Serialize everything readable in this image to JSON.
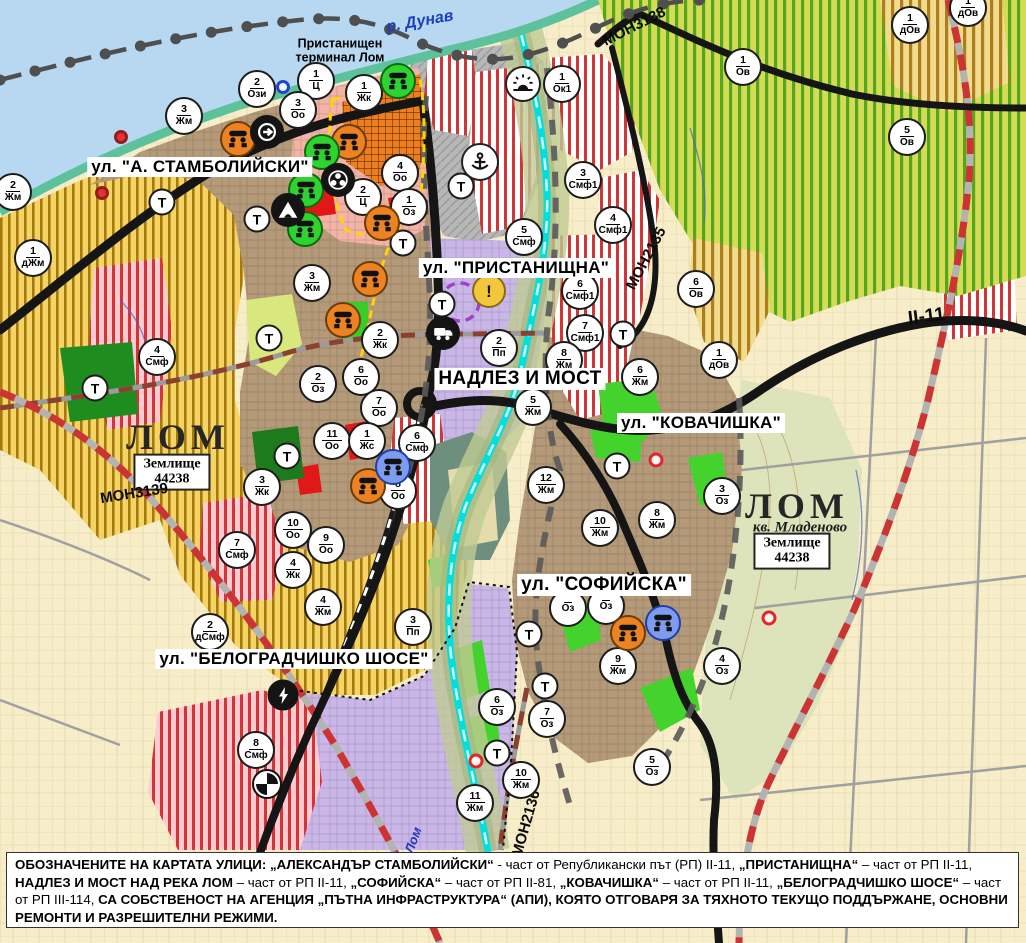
{
  "labels": {
    "danube": "р. Дунав",
    "port_terminal_line1": "Пристанищен",
    "port_terminal_line2": "терминал Лом",
    "lom_river": "Лом",
    "t_symbol": "Т"
  },
  "street_labels": [
    {
      "id": "stamboliyski",
      "text": "ул. \"А. СТАМБОЛИЙСКИ\"",
      "x": 200,
      "y": 167,
      "size": 17
    },
    {
      "id": "pristanishtna",
      "text": "ул. \"ПРИСТАНИЩНА\"",
      "x": 516,
      "y": 268,
      "size": 17
    },
    {
      "id": "nadlez-i-most",
      "text": "НАДЛЕЗ И МОСТ",
      "x": 520,
      "y": 379,
      "size": 19
    },
    {
      "id": "kovachishka",
      "text": "ул. \"КОВАЧИШКА\"",
      "x": 701,
      "y": 423,
      "size": 17
    },
    {
      "id": "sofiyska",
      "text": "ул. \"СОФИЙСКА\"",
      "x": 604,
      "y": 585,
      "size": 19
    },
    {
      "id": "belogradchishko",
      "text": "ул. \"БЕЛОГРАДЧИШКО ШОСЕ\"",
      "x": 294,
      "y": 659,
      "size": 17
    }
  ],
  "city_labels": [
    {
      "id": "lom-west",
      "text": "ЛОМ",
      "x": 178,
      "y": 437
    },
    {
      "id": "lom-east",
      "text": "ЛОМ",
      "x": 797,
      "y": 506
    }
  ],
  "sub_labels": [
    {
      "id": "kv-mladenovo",
      "text": "кв. Младеново",
      "x": 800,
      "y": 528
    }
  ],
  "land_boxes": [
    {
      "line1": "Землище",
      "line2": "44238",
      "x": 172,
      "y": 472
    },
    {
      "line1": "Землище",
      "line2": "44238",
      "x": 792,
      "y": 551
    }
  ],
  "road_labels": [
    {
      "text": "МОН3139",
      "x": 148,
      "y": 494,
      "rotate": -9,
      "size": 15
    },
    {
      "text": "МОН3138",
      "x": 636,
      "y": 29,
      "rotate": -27,
      "size": 15
    },
    {
      "text": "МОН2135",
      "x": 632,
      "y": 260,
      "rotate": -62,
      "size": 15
    },
    {
      "text": "МОН2136",
      "x": 507,
      "y": 827,
      "rotate": -74,
      "size": 15
    },
    {
      "text": "II-11",
      "x": 928,
      "y": 317,
      "rotate": -7,
      "size": 19
    }
  ],
  "zone_markers": [
    {
      "num": "2",
      "code": "Ози",
      "x": 257,
      "y": 89
    },
    {
      "num": "1",
      "code": "Ц",
      "x": 316,
      "y": 81
    },
    {
      "num": "3",
      "code": "Оо",
      "x": 298,
      "y": 110
    },
    {
      "num": "1",
      "code": "Жк",
      "x": 364,
      "y": 93
    },
    {
      "num": "1",
      "code": "Ок1",
      "x": 562,
      "y": 84
    },
    {
      "num": "3",
      "code": "Жм",
      "x": 184,
      "y": 116
    },
    {
      "num": "2",
      "code": "Жм",
      "x": 13,
      "y": 192
    },
    {
      "num": "1",
      "code": "дЖм",
      "x": 33,
      "y": 258
    },
    {
      "num": "4",
      "code": "Оо",
      "x": 400,
      "y": 173
    },
    {
      "num": "2",
      "code": "Ц",
      "x": 363,
      "y": 197
    },
    {
      "num": "1",
      "code": "Оз",
      "x": 409,
      "y": 207
    },
    {
      "num": "3",
      "code": "Жм",
      "x": 312,
      "y": 283
    },
    {
      "num": "2",
      "code": "Жк",
      "x": 380,
      "y": 340
    },
    {
      "num": "4",
      "code": "Смф",
      "x": 157,
      "y": 357
    },
    {
      "num": "2",
      "code": "Оз",
      "x": 318,
      "y": 384
    },
    {
      "num": "6",
      "code": "Оо",
      "x": 361,
      "y": 377
    },
    {
      "num": "7",
      "code": "Оо",
      "x": 379,
      "y": 408
    },
    {
      "num": "11",
      "code": "Оо",
      "x": 332,
      "y": 441
    },
    {
      "num": "1",
      "code": "Жс",
      "x": 367,
      "y": 441
    },
    {
      "num": "3",
      "code": "Жк",
      "x": 262,
      "y": 487
    },
    {
      "num": "6",
      "code": "Смф",
      "x": 417,
      "y": 443
    },
    {
      "num": "8",
      "code": "Оо",
      "x": 398,
      "y": 491
    },
    {
      "num": "10",
      "code": "Оо",
      "x": 293,
      "y": 530
    },
    {
      "num": "9",
      "code": "Оо",
      "x": 326,
      "y": 545
    },
    {
      "num": "4",
      "code": "Жк",
      "x": 293,
      "y": 570
    },
    {
      "num": "7",
      "code": "Смф",
      "x": 237,
      "y": 550
    },
    {
      "num": "4",
      "code": "Жм",
      "x": 323,
      "y": 607
    },
    {
      "num": "2",
      "code": "дСмф",
      "x": 210,
      "y": 632
    },
    {
      "num": "3",
      "code": "Пп",
      "x": 413,
      "y": 627
    },
    {
      "num": "8",
      "code": "Смф",
      "x": 256,
      "y": 750
    },
    {
      "num": "5",
      "code": "Смф",
      "x": 524,
      "y": 237
    },
    {
      "num": "3",
      "code": "Смф1",
      "x": 583,
      "y": 180
    },
    {
      "num": "4",
      "code": "Смф1",
      "x": 613,
      "y": 225
    },
    {
      "num": "6",
      "code": "Смф1",
      "x": 580,
      "y": 291
    },
    {
      "num": "7",
      "code": "Смф1",
      "x": 585,
      "y": 333
    },
    {
      "num": "2",
      "code": "Пп",
      "x": 499,
      "y": 348
    },
    {
      "num": "8",
      "code": "Жм",
      "x": 564,
      "y": 360
    },
    {
      "num": "5",
      "code": "Жм",
      "x": 533,
      "y": 407
    },
    {
      "num": "6",
      "code": "Жм",
      "x": 640,
      "y": 377
    },
    {
      "num": "12",
      "code": "Жм",
      "x": 546,
      "y": 485
    },
    {
      "num": "10",
      "code": "Жм",
      "x": 600,
      "y": 528
    },
    {
      "num": "8",
      "code": "Жм",
      "x": 657,
      "y": 520
    },
    {
      "num": "3",
      "code": "Оз",
      "x": 722,
      "y": 496
    },
    {
      "num": "6",
      "code": "Ов",
      "x": 696,
      "y": 289
    },
    {
      "num": "1",
      "code": "дОв",
      "x": 719,
      "y": 360
    },
    {
      "num": "1",
      "code": "Ов",
      "x": 743,
      "y": 67
    },
    {
      "num": "5",
      "code": "Ов",
      "x": 907,
      "y": 137
    },
    {
      "num": "1",
      "code": "дОв",
      "x": 910,
      "y": 25
    },
    {
      "num": "1",
      "code": "дОв",
      "x": 968,
      "y": 8
    },
    {
      "num": "9",
      "code": "Жм",
      "x": 618,
      "y": 666
    },
    {
      "num": "4",
      "code": "Оз",
      "x": 722,
      "y": 666
    },
    {
      "num": "6",
      "code": "Оз",
      "x": 497,
      "y": 707
    },
    {
      "num": "7",
      "code": "Оз",
      "x": 547,
      "y": 719
    },
    {
      "num": "10",
      "code": "Жм",
      "x": 521,
      "y": 780
    },
    {
      "num": "11",
      "code": "Жм",
      "x": 475,
      "y": 803
    },
    {
      "num": "5",
      "code": "Оз",
      "x": 652,
      "y": 767
    },
    {
      "num": "",
      "code": "Оз",
      "x": 568,
      "y": 608
    },
    {
      "num": "",
      "code": "Оз",
      "x": 606,
      "y": 606
    }
  ],
  "t_markers": [
    {
      "x": 162,
      "y": 202
    },
    {
      "x": 257,
      "y": 219
    },
    {
      "x": 269,
      "y": 338
    },
    {
      "x": 287,
      "y": 456
    },
    {
      "x": 95,
      "y": 388
    },
    {
      "x": 403,
      "y": 243
    },
    {
      "x": 442,
      "y": 304
    },
    {
      "x": 461,
      "y": 186
    },
    {
      "x": 623,
      "y": 334
    },
    {
      "x": 617,
      "y": 466
    },
    {
      "x": 529,
      "y": 634
    },
    {
      "x": 545,
      "y": 686
    },
    {
      "x": 497,
      "y": 753
    }
  ],
  "icon_markers": [
    {
      "type": "monument-orange",
      "x": 238,
      "y": 139
    },
    {
      "type": "monument-orange",
      "x": 349,
      "y": 142
    },
    {
      "type": "monument-orange",
      "x": 382,
      "y": 223
    },
    {
      "type": "monument-orange",
      "x": 370,
      "y": 279
    },
    {
      "type": "monument-orange",
      "x": 343,
      "y": 320
    },
    {
      "type": "monument-orange",
      "x": 368,
      "y": 486
    },
    {
      "type": "monument-orange",
      "x": 628,
      "y": 633
    },
    {
      "type": "monument-green",
      "x": 398,
      "y": 81
    },
    {
      "type": "monument-green",
      "x": 322,
      "y": 152
    },
    {
      "type": "monument-green",
      "x": 306,
      "y": 190
    },
    {
      "type": "monument-green",
      "x": 305,
      "y": 229
    },
    {
      "type": "monument-blue",
      "x": 393,
      "y": 467
    },
    {
      "type": "monument-blue",
      "x": 663,
      "y": 623
    },
    {
      "type": "circled-arrow",
      "x": 267,
      "y": 132
    },
    {
      "type": "triple-dot",
      "x": 338,
      "y": 180
    },
    {
      "type": "tunnel",
      "x": 288,
      "y": 210
    },
    {
      "type": "anchor",
      "x": 480,
      "y": 162
    },
    {
      "type": "sunrise",
      "x": 523,
      "y": 84
    },
    {
      "type": "warning",
      "x": 489,
      "y": 291
    },
    {
      "type": "truck",
      "x": 443,
      "y": 333
    },
    {
      "type": "lightning",
      "x": 283,
      "y": 695
    },
    {
      "type": "crossing",
      "x": 267,
      "y": 784
    }
  ],
  "ring_markers": [
    {
      "kind": "red-dot",
      "x": 121,
      "y": 137
    },
    {
      "kind": "red-dot",
      "x": 102,
      "y": 193
    },
    {
      "kind": "red-ring",
      "x": 656,
      "y": 460
    },
    {
      "kind": "red-ring",
      "x": 476,
      "y": 761
    },
    {
      "kind": "red-ring",
      "x": 769,
      "y": 618
    },
    {
      "kind": "blue-ring",
      "x": 283,
      "y": 87
    }
  ],
  "footer": {
    "segments": [
      {
        "t": "ОБОЗНАЧЕНИТЕ НА КАРТАТА УЛИЦИ: ",
        "b": true
      },
      {
        "t": "„АЛЕКСАНДЪР СТАМБОЛИЙСКИ“",
        "b": true
      },
      {
        "t": " - част от Републикански път (РП) II-11, ",
        "b": false
      },
      {
        "t": "„ПРИСТАНИЩНА“",
        "b": true
      },
      {
        "t": " – част от РП II-11, ",
        "b": false
      },
      {
        "t": "НАДЛЕЗ И МОСТ НАД РЕКА ЛОМ",
        "b": true
      },
      {
        "t": " – част от РП II-11, ",
        "b": false
      },
      {
        "t": "„СОФИЙСКА“",
        "b": true
      },
      {
        "t": " – част от РП II-81, ",
        "b": false
      },
      {
        "t": "„КОВАЧИШКА“",
        "b": true
      },
      {
        "t": " – част от РП II-11, ",
        "b": false
      },
      {
        "t": "„БЕЛОГРАДЧИШКО ШОСЕ“",
        "b": true
      },
      {
        "t": " – част от РП III-114, ",
        "b": false
      },
      {
        "t": "СА СОБСТВЕНОСТ НА АГЕНЦИЯ „ПЪТНА ИНФРАСТРУКТУРА“ (АПИ), КОЯТО ОТГОВАРЯ ЗА ТЯХНОТО ТЕКУЩО ПОДДЪРЖАНЕ, ОСНОВНИ РЕМОНТИ И РАЗРЕШИТЕЛНИ РЕЖИМИ.",
        "b": true
      }
    ]
  },
  "colors": {
    "water": "#b7d8f0",
    "river_lom": "#00dede",
    "residential_brown": "#b49a79",
    "farmland_cream": "#f7edc8",
    "production_lilac": "#cab7e8",
    "mixed_red_stripe": "#d53434",
    "vineyard_green": "#55a61e",
    "park_green": "#1f8c1f",
    "road_black": "#151515",
    "railway_red": "#cc3333",
    "center_boundary_yellow": "#ffd400"
  }
}
